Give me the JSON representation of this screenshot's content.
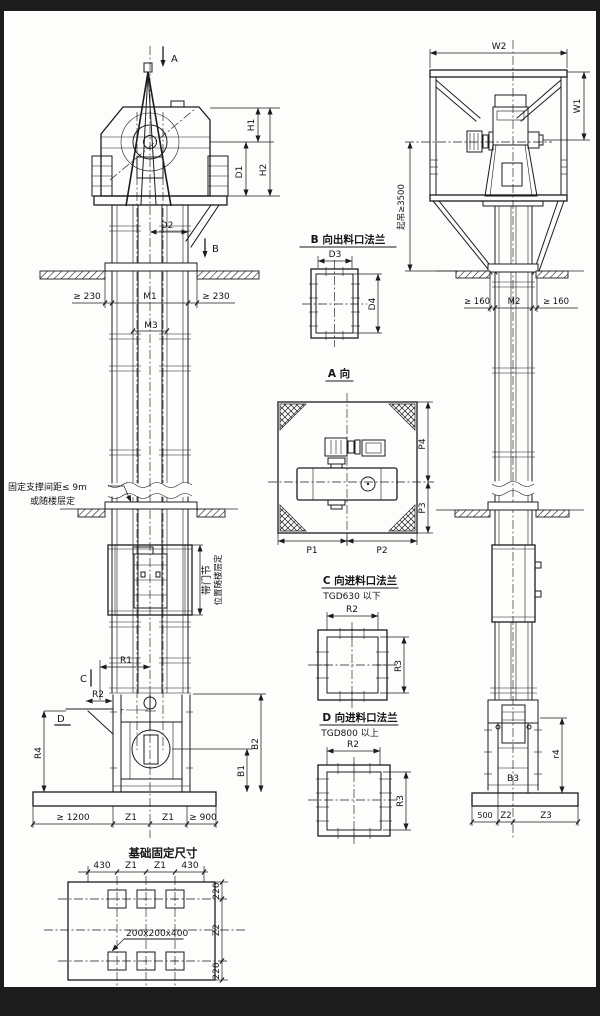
{
  "meta": {
    "drawing_type": "bucket elevator installation outline drawing",
    "colors": {
      "line": "#1c1c1c",
      "paper": "#ffffff",
      "frame": "#000000"
    }
  },
  "front_view": {
    "markers": {
      "a": "A",
      "b": "B",
      "c": "C",
      "d": "D"
    },
    "dims": {
      "h1": "H1",
      "h2": "H2",
      "d1": "D1",
      "d2": "D2",
      "clear230": "≥ 230",
      "m1": "M1",
      "m3": "M3",
      "r1": "R1",
      "r2": "R2",
      "r_small": "r",
      "r4": "R4",
      "b1": "B1",
      "b2": "B2",
      "base_left": "≥ 1200",
      "z1": "Z1",
      "base_right": "≥ 900"
    },
    "notes": {
      "support1": "固定支撑间距≤ 9m",
      "support2": "或随楼层定",
      "door1": "带门节",
      "door2": "位置随楼层定"
    }
  },
  "foundation_plan": {
    "title": "基础固定尺寸",
    "dims": {
      "a430": "430",
      "z1": "Z1",
      "a220": "220",
      "z2": "Z2",
      "pocket": "200x200x400"
    }
  },
  "detail_b": {
    "title": "B 向出料口法兰",
    "dims": {
      "d3": "D3",
      "d4": "D4"
    }
  },
  "view_a": {
    "title": "A 向",
    "dims": {
      "p1": "P1",
      "p2": "P2",
      "p3": "P3",
      "p4": "P4"
    }
  },
  "detail_c": {
    "title": "C 向进料口法兰",
    "subtitle": "TGD630 以下",
    "dims": {
      "r2": "R2",
      "r3": "R3"
    }
  },
  "detail_d": {
    "title": "D 向进料口法兰",
    "subtitle": "TGD800 以上",
    "dims": {
      "r2": "R2",
      "r3": "R3"
    }
  },
  "side_view": {
    "dims": {
      "w1": "W1",
      "w2": "W2",
      "hoist": "起吊≥3500",
      "clear160": "≥ 160",
      "m2": "M2",
      "r4": "r4",
      "b3": "B3",
      "n500": "500",
      "z2": "Z2",
      "z3": "Z3"
    }
  }
}
